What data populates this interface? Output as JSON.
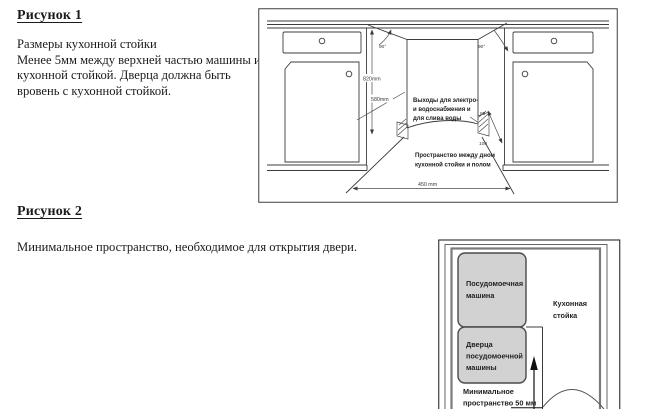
{
  "document": {
    "figure1": {
      "heading": "Рисунок 1",
      "caption_lines": [
        "Размеры кухонной стойки",
        "Менее 5мм между верхней частью машины и",
        "кухонной стойкой. Дверца должна быть",
        "вровень с кухонной стойкой."
      ],
      "labels": {
        "angle_left": "90°",
        "angle_right": "90°",
        "height": "820mm",
        "depth": "580mm",
        "width": "450 mm",
        "gap_top": "80",
        "gap_bottom": "100",
        "outlets_line1": "Выходы для электро-",
        "outlets_line2": "и водоснабжения и",
        "outlets_line3": "для слива воды",
        "floor_space_line1": "Пространство между дном",
        "floor_space_line2": "кухонной стойки и полом"
      }
    },
    "figure2": {
      "heading": "Рисунок 2",
      "caption": "Минимальное пространство, необходимое для открытия двери.",
      "labels": {
        "dishwasher_line1": "Посудомоечная",
        "dishwasher_line2": "машина",
        "door_line1": "Дверца",
        "door_line2": "посудомоечной",
        "door_line3": "машины",
        "counter_line1": "Кухонная",
        "counter_line2": "стойка",
        "min_space_line1": "Минимальное",
        "min_space_line2_prefix": "пространство ",
        "min_space_value": "50 мм"
      }
    }
  },
  "colors": {
    "page_bg": "#ffffff",
    "text": "#1b1b1b",
    "diagram_line": "#3c3c3c",
    "gray_box_fill": "#d2d2d2",
    "counter_outline": "#7b7b7b"
  }
}
